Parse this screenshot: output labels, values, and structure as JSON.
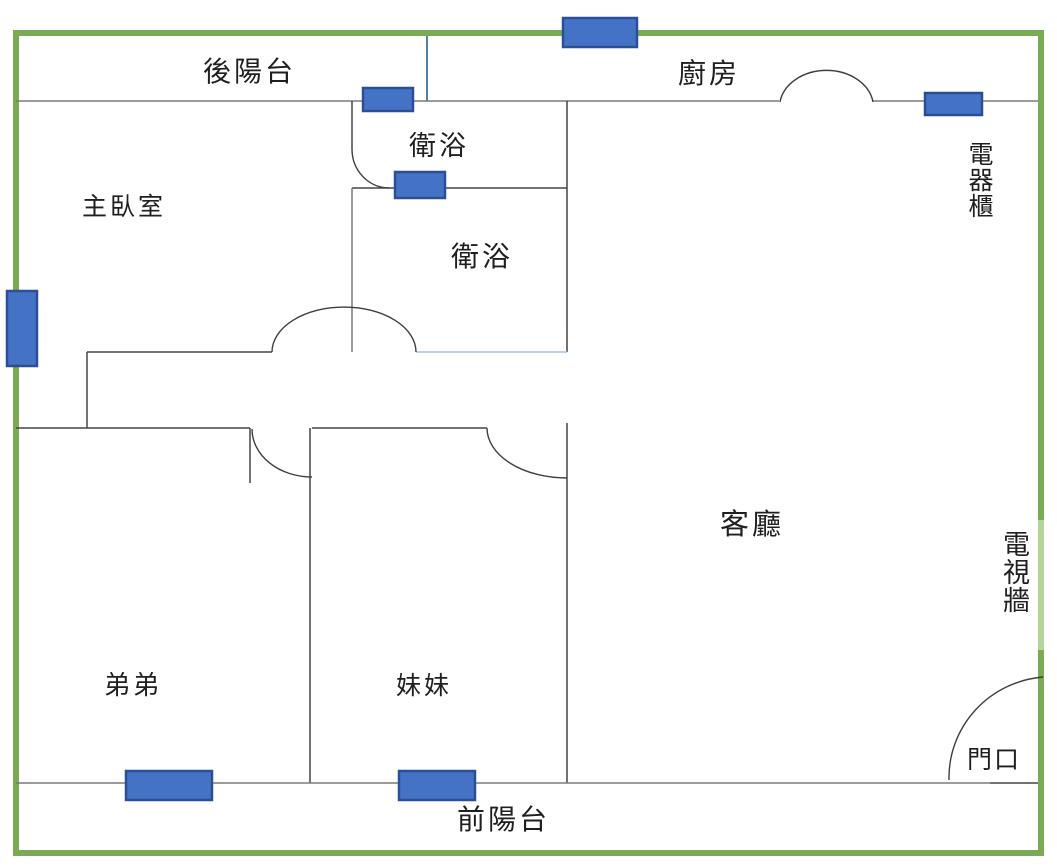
{
  "figure": {
    "kind": "apartment-floor-plan",
    "background": "#ffffff"
  },
  "colors": {
    "boundary_green": "#7CA953",
    "boundary_green_light": "#B5D49B",
    "window_fill": "#4472C4",
    "window_border": "#2B4F96",
    "wall_gray": "#7a7a7a",
    "wall_dark": "#454545",
    "water_line_blue": "#9CC3E5",
    "connector_blue": "#41719C"
  },
  "labels": {
    "back_balcony": "後陽台",
    "kitchen": "廚房",
    "appliance_cabinet": "電器櫃",
    "master_bedroom": "主臥室",
    "bathroom_small": "衛浴",
    "bathroom_main": "衛浴",
    "living_room": "客廳",
    "tv_wall": "電視牆",
    "brother_room": "弟弟",
    "sister_room": "妹妹",
    "front_balcony": "前陽台",
    "entrance": "門口"
  },
  "markers": {
    "window_markers": [
      "top-exterior-window",
      "back-balcony-window",
      "bathroom-window",
      "kitchen-window",
      "master-bedroom-side-window",
      "brother-room-window",
      "sister-room-window"
    ],
    "door_arcs": [
      "kitchen-door-arc",
      "bathroom-small-door-arc",
      "master-bedroom-door-arc",
      "brother-room-door-arc",
      "sister-room-door-arc",
      "entrance-door-arc"
    ]
  }
}
